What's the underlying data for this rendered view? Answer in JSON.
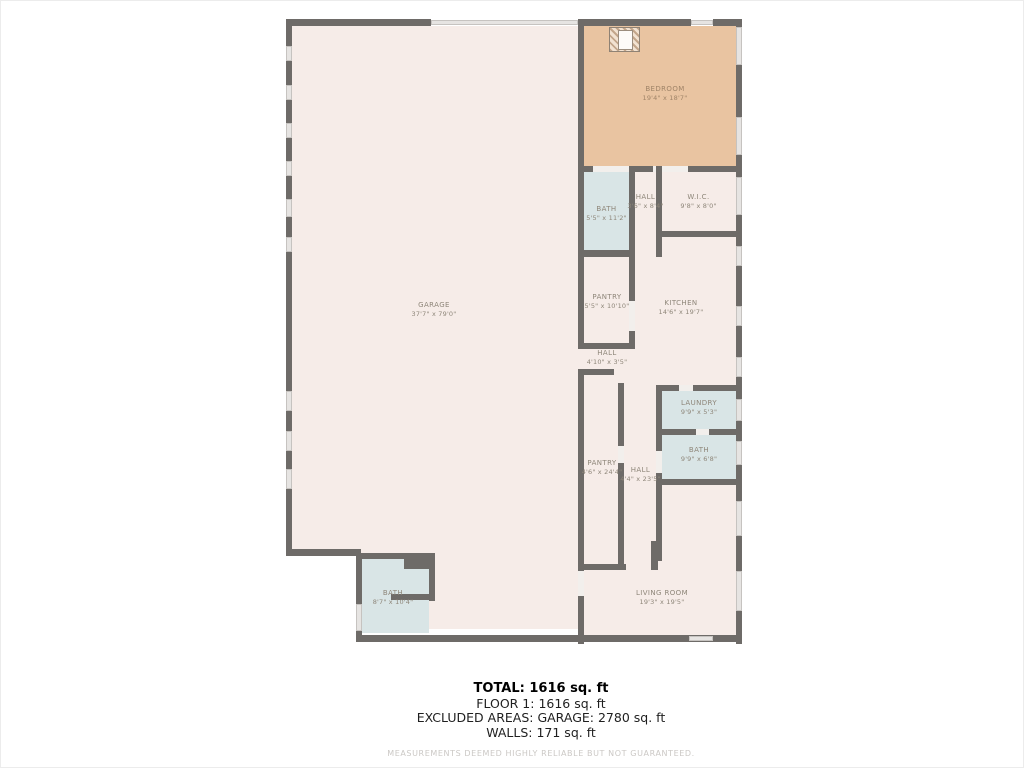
{
  "title": "Floor plan",
  "rooms": [
    {
      "name": "GARAGE",
      "dims": "37'7\" x 79'0\""
    },
    {
      "name": "BEDROOM",
      "dims": "19'4\" x 18'7\""
    },
    {
      "name": "BATH",
      "dims": "5'5\" x 11'2\""
    },
    {
      "name": "HALL",
      "dims": "3'6\" x 8'4\""
    },
    {
      "name": "W.I.C.",
      "dims": "9'8\" x 8'0\""
    },
    {
      "name": "PANTRY",
      "dims": "5'5\" x 10'10\""
    },
    {
      "name": "KITCHEN",
      "dims": "14'6\" x 19'7\""
    },
    {
      "name": "HALL",
      "dims": "4'10\" x 3'5\""
    },
    {
      "name": "PANTRY",
      "dims": "4'6\" x 24'4\""
    },
    {
      "name": "HALL",
      "dims": "4'4\" x 23'5\""
    },
    {
      "name": "LAUNDRY",
      "dims": "9'9\" x 5'3\""
    },
    {
      "name": "BATH",
      "dims": "9'9\" x 6'8\""
    },
    {
      "name": "LIVING ROOM",
      "dims": "19'3\" x 19'5\""
    },
    {
      "name": "BATH",
      "dims": "8'7\" x 10'4\""
    }
  ],
  "summary": {
    "total": "TOTAL: 1616 sq. ft",
    "floor1": "FLOOR 1: 1616 sq. ft",
    "excluded": "EXCLUDED AREAS: GARAGE: 2780 sq. ft",
    "walls": "WALLS: 171 sq. ft",
    "disclaimer": "MEASUREMENTS DEEMED HIGHLY RELIABLE BUT NOT GUARANTEED."
  },
  "colors": {
    "wall": "#6e6b68",
    "floor": "#f6ece8",
    "bedroom": "#e9c4a1",
    "wet_room": "#d9e5e6",
    "window": "#e6e4e2"
  }
}
